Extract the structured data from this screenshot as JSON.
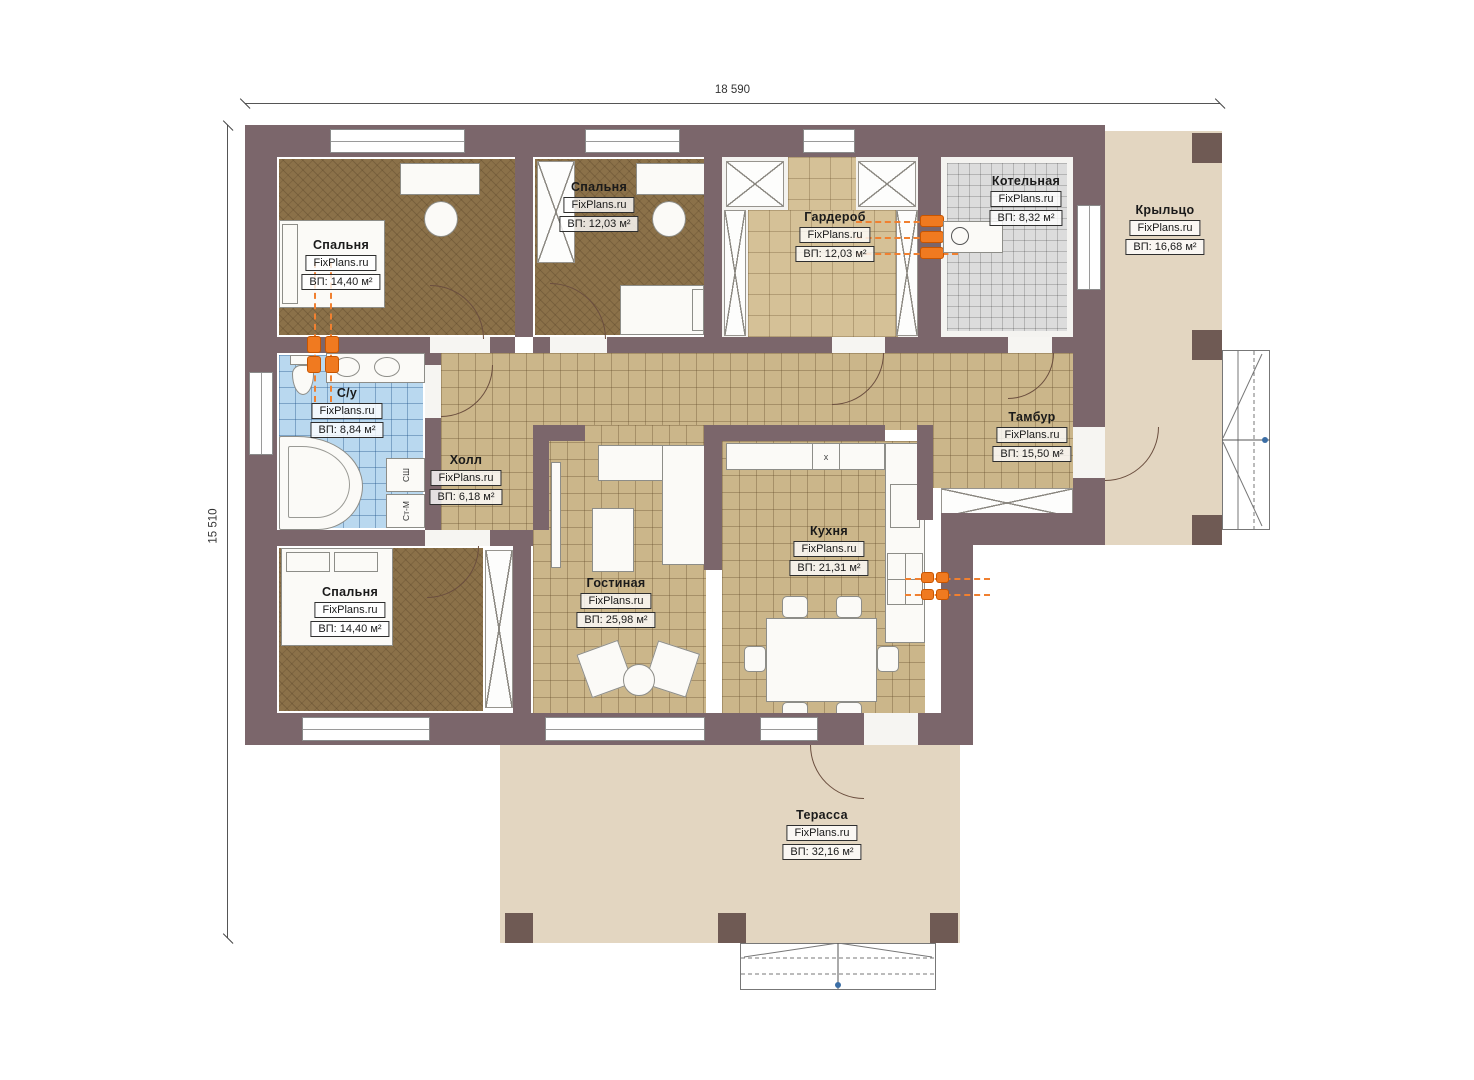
{
  "brand": "FixPlans.ru",
  "dimensions": {
    "width_label": "18 590",
    "height_label": "15 510"
  },
  "rooms": [
    {
      "id": "bedroom-1",
      "name": "Спальня",
      "area": "ВП: 14,40 м²"
    },
    {
      "id": "bedroom-2",
      "name": "Спальня",
      "area": "ВП: 12,03 м²"
    },
    {
      "id": "wardrobe",
      "name": "Гардероб",
      "area": "ВП: 12,03 м²"
    },
    {
      "id": "boiler-room",
      "name": "Котельная",
      "area": "ВП: 8,32 м²"
    },
    {
      "id": "porch",
      "name": "Крыльцо",
      "area": "ВП: 16,68 м²"
    },
    {
      "id": "bathroom",
      "name": "С/у",
      "area": "ВП: 8,84 м²"
    },
    {
      "id": "hall",
      "name": "Холл",
      "area": "ВП: 6,18 м²"
    },
    {
      "id": "vestibule",
      "name": "Тамбур",
      "area": "ВП: 15,50 м²"
    },
    {
      "id": "kitchen",
      "name": "Кухня",
      "area": "ВП: 21,31 м²"
    },
    {
      "id": "living-room",
      "name": "Гостиная",
      "area": "ВП: 25,98 м²"
    },
    {
      "id": "bedroom-3",
      "name": "Спальня",
      "area": "ВП: 14,40 м²"
    },
    {
      "id": "terrace",
      "name": "Терасса",
      "area": "ВП: 32,16 м²"
    }
  ],
  "appliances": {
    "dryer_label": "СШ",
    "washer_label": "Ст-М",
    "kitchen_vent_marker": "x"
  },
  "colors": {
    "wall": "#7b666b",
    "pillar": "#6f5a54",
    "wood_floor": "#8b7149",
    "tile_tan": "#cbb68a",
    "tile_blue": "#b9d8ef",
    "tile_gray": "#dcdcdc",
    "terrace_floor": "#e3d6c1",
    "heating_accent": "#f07a20"
  }
}
